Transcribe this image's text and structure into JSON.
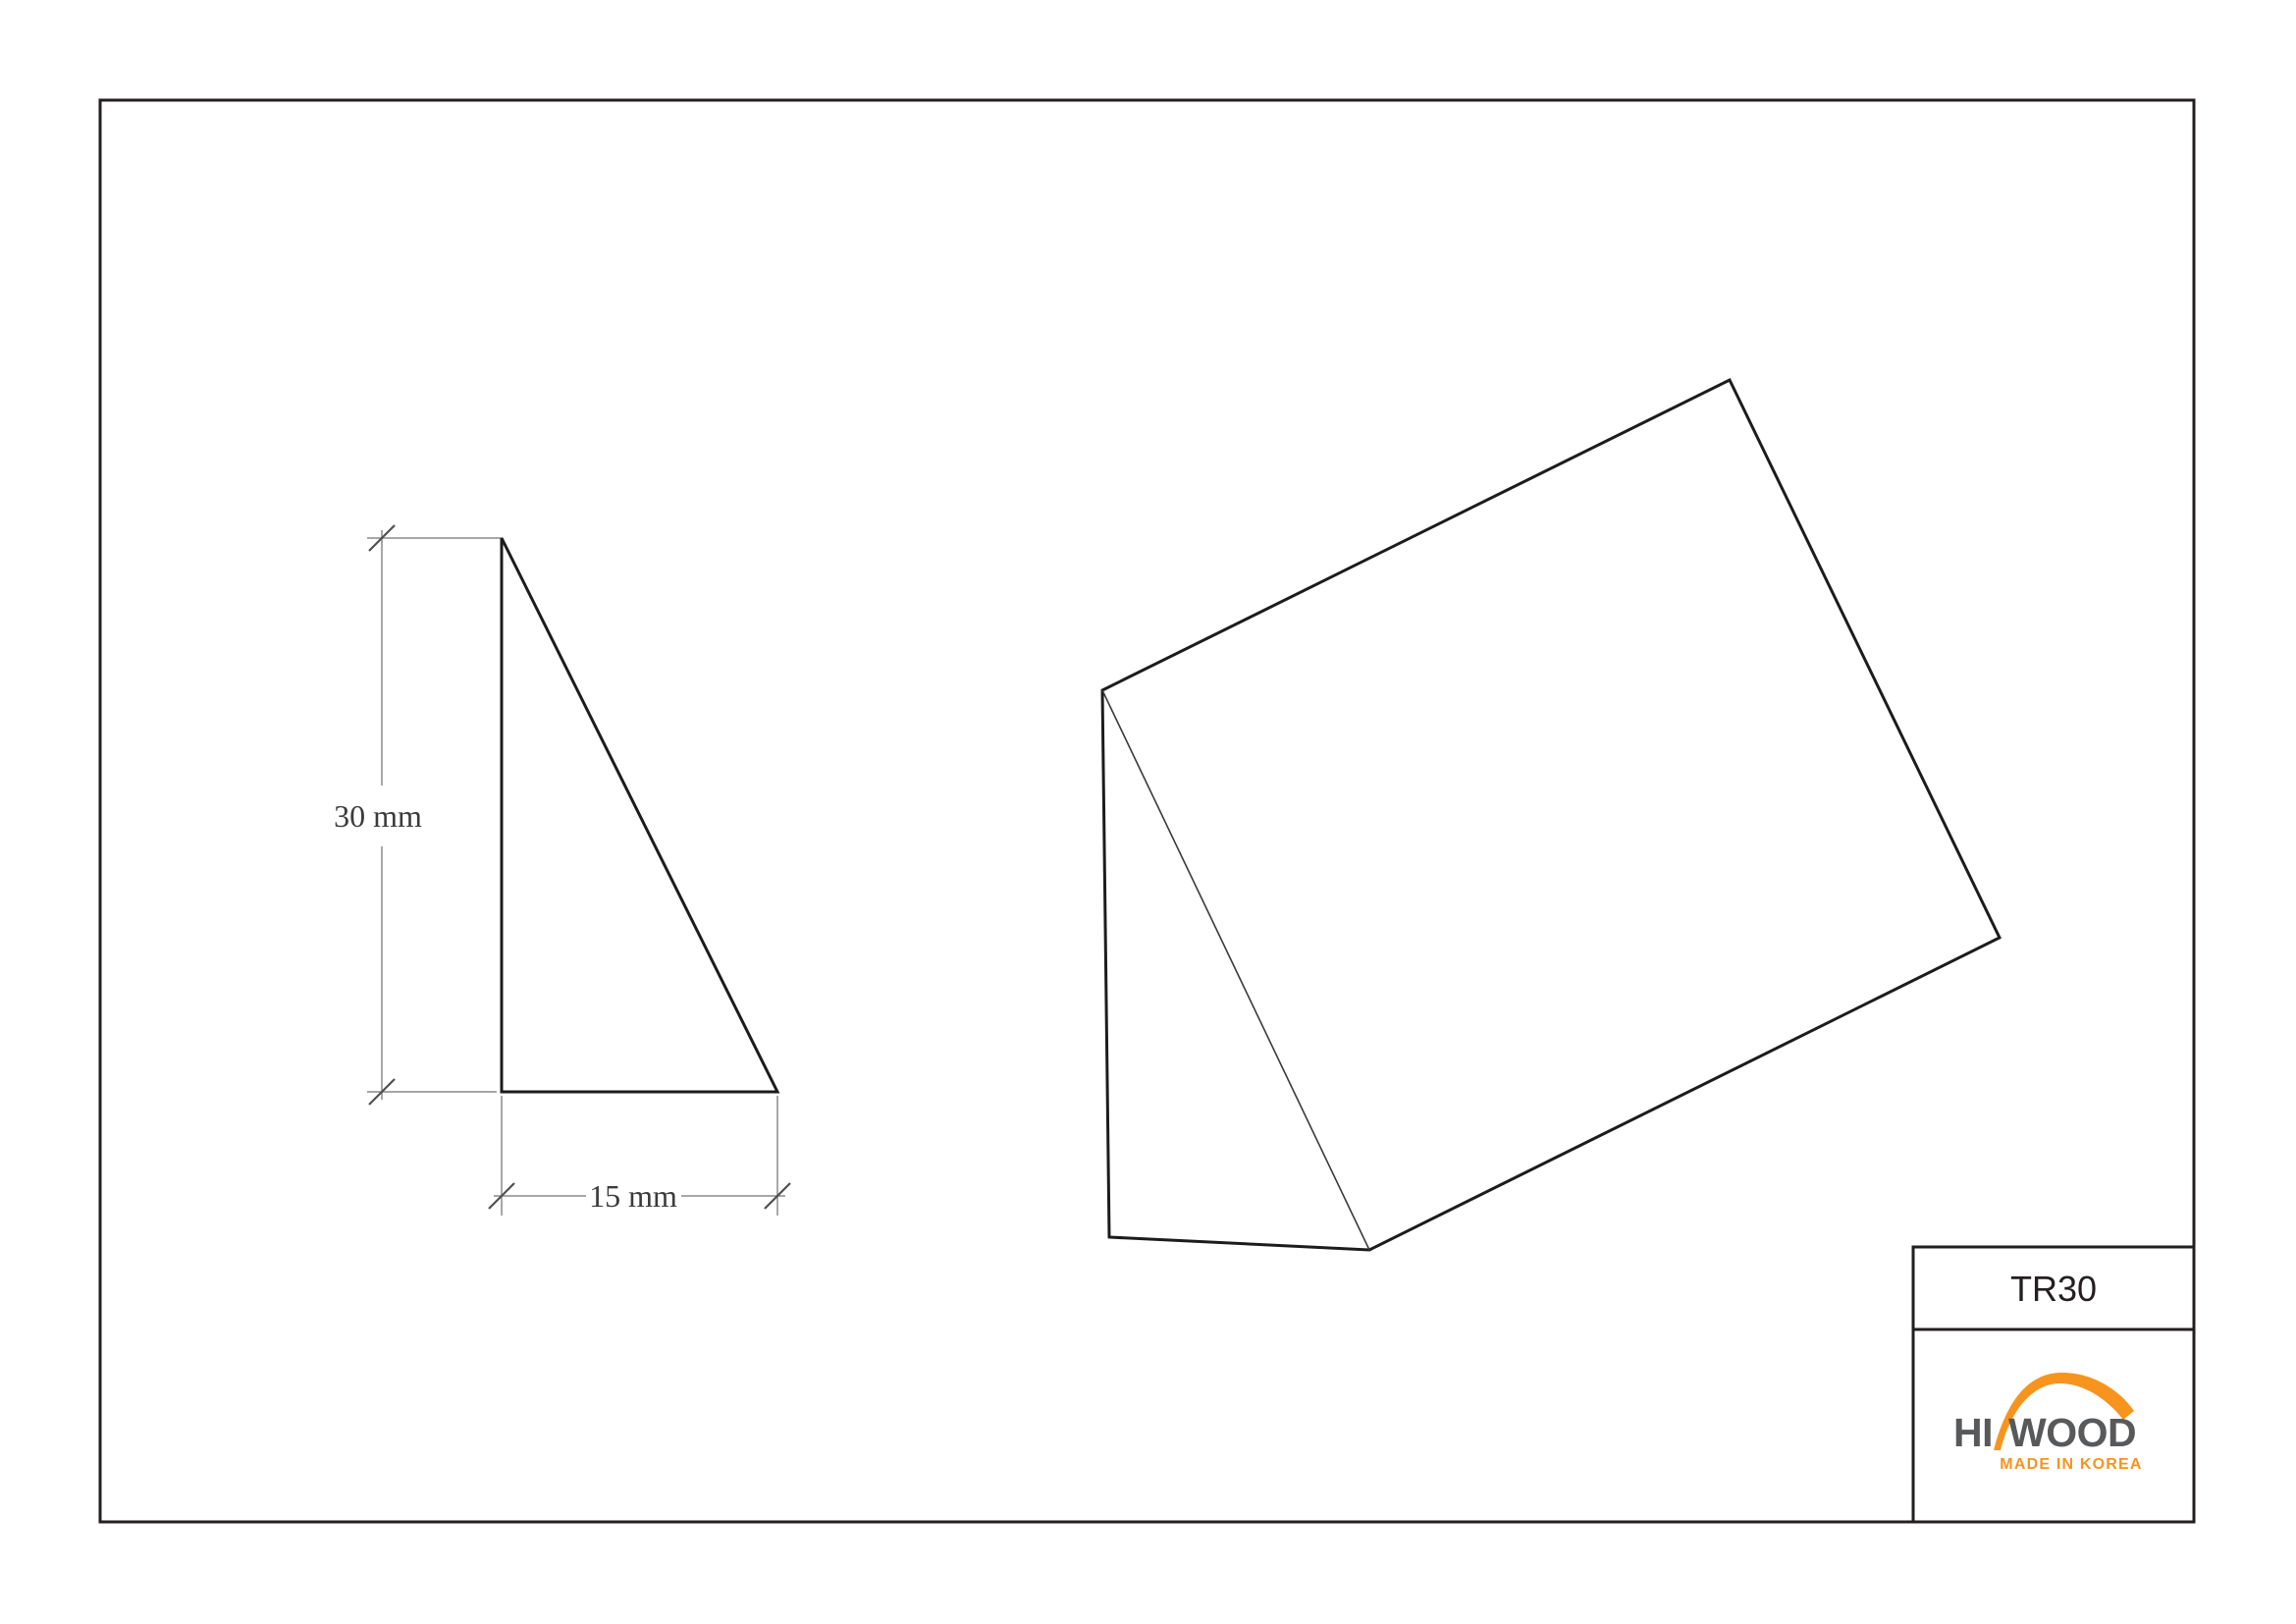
{
  "sheet": {
    "background": "#FFFFFF",
    "frame_color": "#231F20",
    "drawing_line_color": "#1C1C1C",
    "dimension_line_color": "#8A8A8A",
    "dimension_text_color": "#3B3B3B"
  },
  "front_view": {
    "shape": "right-triangle cross-section",
    "height_dim": {
      "label": "30 mm",
      "value_mm": 30
    },
    "width_dim": {
      "label": "15 mm",
      "value_mm": 15
    }
  },
  "iso_view": {
    "shape": "triangular prism"
  },
  "title_block": {
    "model_code": "TR30",
    "model_text_color": "#231F20",
    "logo": {
      "word1": "HI",
      "word2": "WOOD",
      "tagline": "MADE IN KOREA",
      "text_color": "#58595B",
      "accent_color": "#F7941E"
    }
  }
}
